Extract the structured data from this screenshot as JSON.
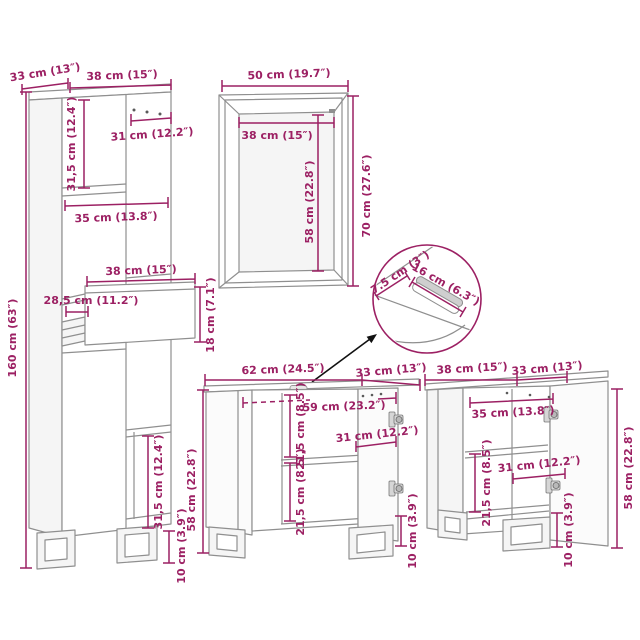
{
  "tall_cabinet": {
    "depth": "33 cm (13″)",
    "width": "38 cm (15″)",
    "door_width": "31 cm (12.2″)",
    "upper_compartment_height": "31,5 cm (12.4″)",
    "shelf_width": "35 cm (13.8″)",
    "drawer_width": "38 cm (15″)",
    "drawer_depth": "28,5 cm (11.2″)",
    "drawer_height": "18 cm (7.1″)",
    "height": "160 cm (63″)",
    "lower_compartment_height": "31,5 cm (12.4″)",
    "leg_height": "10 cm (3.9″)"
  },
  "mirror": {
    "width": "50 cm (19.7″)",
    "glass_width": "38 cm (15″)",
    "glass_height": "58 cm (22.8″)",
    "height": "70 cm (27.6″)"
  },
  "handle_detail": {
    "depth": "7.5 cm (3″)",
    "width": "16 cm (6.3″)"
  },
  "vanity": {
    "width": "62 cm (24.5″)",
    "depth": "33 cm (13″)",
    "inner_width": "59 cm (23.2″)",
    "upper_compartment_height": "21,5 cm (8.5″)",
    "door_width": "31 cm (12.2″)",
    "lower_compartment_height": "21,5 cm (8.5″)",
    "height": "58 cm (22.8″)",
    "leg_height": "10 cm (3.9″)"
  },
  "side_cabinet": {
    "width": "38 cm (15″)",
    "depth": "33 cm (13″)",
    "shelf_width": "35 cm (13.8″)",
    "compartment_height": "21,5 cm (8.5″)",
    "door_width": "31 cm (12.2″)",
    "height": "58 cm (22.8″)",
    "leg_height": "10 cm (3.9″)"
  },
  "colors": {
    "dimension": "#9C2063",
    "outline": "#8F8F8F",
    "detail_circle": "#9C2063",
    "arrow": "#111111"
  }
}
